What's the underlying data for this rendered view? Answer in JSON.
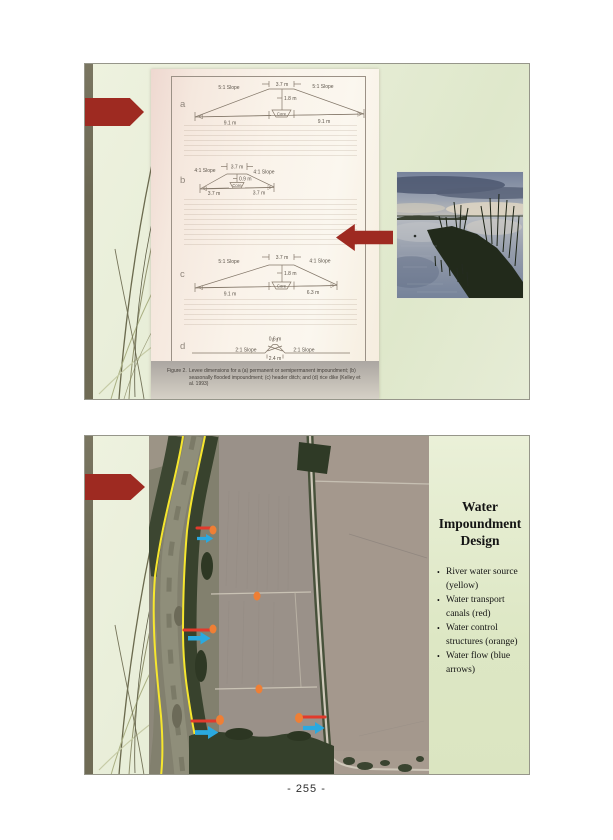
{
  "page": {
    "number": "- 255 -"
  },
  "slide1": {
    "figure": {
      "caption_label": "Figure 2.",
      "caption_text": "Levee dimensions for a (a) permanent or semipermanent impoundment; (b) seasonally flooded impoundment; (c) header ditch; and (d) rice dike (Kelley et al. 1993)",
      "diagrams": [
        {
          "label": "a",
          "left_slope": "5:1 Slope",
          "right_slope": "5:1 Slope",
          "crest_width": "3.7 m",
          "height_dim": "1.8 m",
          "core": "Core",
          "left_base": "9.1 m",
          "right_base": "9.1 m"
        },
        {
          "label": "b",
          "left_slope": "4:1 Slope",
          "right_slope": "4:1 Slope",
          "crest_width": "3.7 m",
          "height_dim": "0.9 m",
          "core": "Core",
          "left_base": "3.7 m",
          "right_base": "3.7 m"
        },
        {
          "label": "c",
          "left_slope": "5:1 Slope",
          "right_slope": "4:1 Slope",
          "crest_width": "3.7 m",
          "height_dim": "1.8 m",
          "core": "Core",
          "left_base": "9.1 m",
          "right_base": "6.3 m"
        },
        {
          "label": "d",
          "left_slope": "2:1 Slope",
          "right_slope": "2:1 Slope",
          "crest_width": "0.6 m",
          "base_width": "2.4 m"
        }
      ]
    }
  },
  "slide2": {
    "panel": {
      "title": "Water Impoundment Design",
      "bullets": [
        "River water source (yellow)",
        "Water transport canals (red)",
        "Water control structures (orange)",
        "Water flow (blue arrows)"
      ]
    }
  },
  "colors": {
    "slide_background": "#e4ebd3",
    "accent_arrow_red": "#9e2a21",
    "river_yellow": "#f6e62e",
    "canal_red": "#e23a2c",
    "structure_orange": "#ef7f35",
    "flow_blue": "#2aa9e0",
    "edge_bar_olive": "#6f6b55"
  }
}
